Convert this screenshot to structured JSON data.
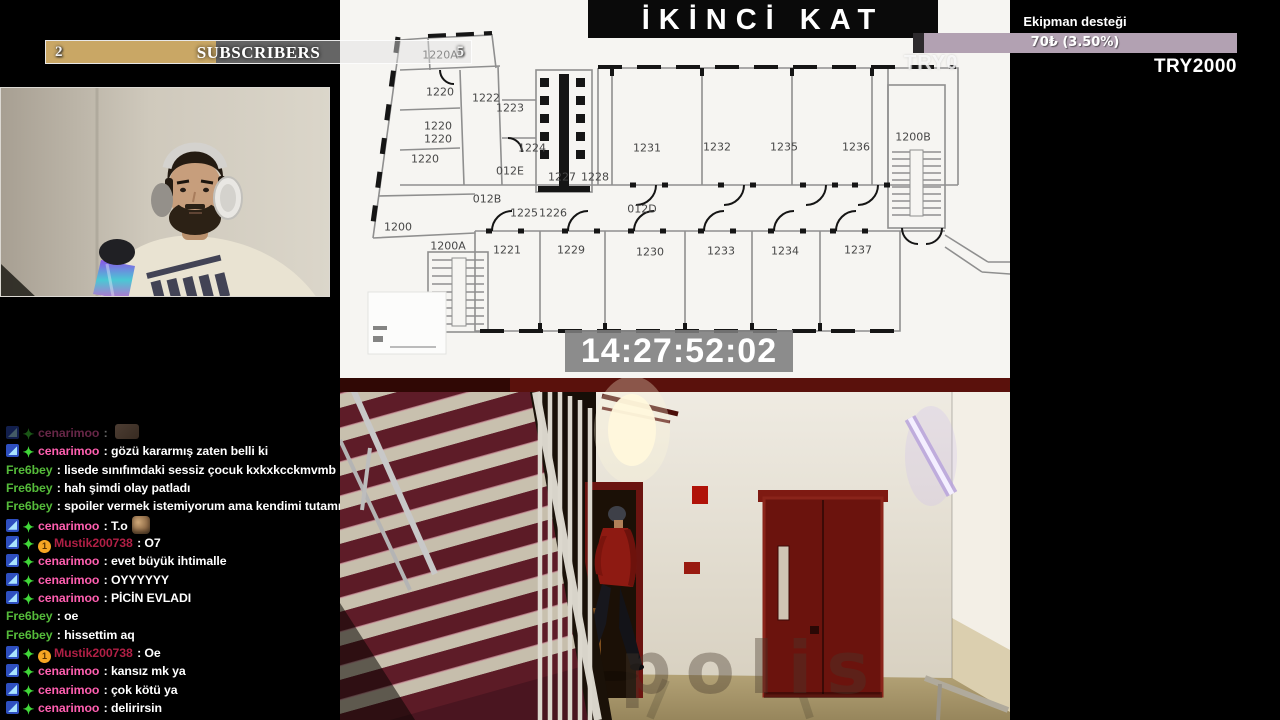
{
  "subscribers_bar": {
    "current": "2",
    "label": "SUBSCRIBERS",
    "goal": "5",
    "fill_pct": 40
  },
  "support_bar": {
    "title": "Ekipman desteği",
    "value": "70₺ (3.50%)",
    "total": "TRY2000",
    "fill_pct": 3.5
  },
  "floorplan": {
    "title": "İKİNCİ KAT",
    "timestamp": "14:27:52:02",
    "watermark": "TRY0",
    "rooms": [
      {
        "label": "1220A",
        "x": 100,
        "y": 55
      },
      {
        "label": "1220",
        "x": 100,
        "y": 92
      },
      {
        "label": "1222",
        "x": 146,
        "y": 98
      },
      {
        "label": "1223",
        "x": 170,
        "y": 108
      },
      {
        "label": "1220",
        "x": 98,
        "y": 126
      },
      {
        "label": "1220",
        "x": 98,
        "y": 139
      },
      {
        "label": "1224",
        "x": 192,
        "y": 148
      },
      {
        "label": "1220",
        "x": 85,
        "y": 159
      },
      {
        "label": "012E",
        "x": 170,
        "y": 171
      },
      {
        "label": "1227",
        "x": 222,
        "y": 177
      },
      {
        "label": "1228",
        "x": 255,
        "y": 177
      },
      {
        "label": "012B",
        "x": 147,
        "y": 199
      },
      {
        "label": "1225",
        "x": 184,
        "y": 213
      },
      {
        "label": "1226",
        "x": 213,
        "y": 213
      },
      {
        "label": "012D",
        "x": 302,
        "y": 209
      },
      {
        "label": "1200",
        "x": 58,
        "y": 227
      },
      {
        "label": "1200A",
        "x": 108,
        "y": 246
      },
      {
        "label": "1221",
        "x": 167,
        "y": 250
      },
      {
        "label": "1229",
        "x": 231,
        "y": 250
      },
      {
        "label": "1230",
        "x": 310,
        "y": 252
      },
      {
        "label": "1233",
        "x": 381,
        "y": 251
      },
      {
        "label": "1234",
        "x": 445,
        "y": 251
      },
      {
        "label": "1237",
        "x": 518,
        "y": 250
      },
      {
        "label": "1231",
        "x": 307,
        "y": 148
      },
      {
        "label": "1232",
        "x": 377,
        "y": 147
      },
      {
        "label": "1235",
        "x": 444,
        "y": 147
      },
      {
        "label": "1236",
        "x": 516,
        "y": 147
      },
      {
        "label": "1200B",
        "x": 573,
        "y": 137
      }
    ]
  },
  "cctv": {
    "watermark": "polis"
  },
  "chat": {
    "user_colors": {
      "cenarimoo": "#ff5fb0",
      "Fre6bey": "#55bb3a",
      "Mustik200738": "#b01f45"
    },
    "messages": [
      {
        "user": "cenarimoo",
        "badges": [
          "predict",
          "gift"
        ],
        "text": "",
        "emote": "small",
        "faded": true
      },
      {
        "user": "cenarimoo",
        "badges": [
          "predict",
          "gift"
        ],
        "text": "gözü kararmış zaten belli ki"
      },
      {
        "user": "Fre6bey",
        "badges": [],
        "text": "lisede sınıfımdaki sessiz çocuk kxkxkcckmvmb"
      },
      {
        "user": "Fre6bey",
        "badges": [],
        "text": "hah şimdi olay patladı"
      },
      {
        "user": "Fre6bey",
        "badges": [],
        "text": "spoiler vermek istemiyorum ama kendimi tutamıyorum"
      },
      {
        "user": "cenarimoo",
        "badges": [
          "predict",
          "gift"
        ],
        "text": "T.o",
        "emote": "face"
      },
      {
        "user": "Mustik200738",
        "badges": [
          "predict",
          "gift",
          "one"
        ],
        "text": "O7"
      },
      {
        "user": "cenarimoo",
        "badges": [
          "predict",
          "gift"
        ],
        "text": "evet büyük ihtimalle"
      },
      {
        "user": "cenarimoo",
        "badges": [
          "predict",
          "gift"
        ],
        "text": "OYYYYYY"
      },
      {
        "user": "cenarimoo",
        "badges": [
          "predict",
          "gift"
        ],
        "text": "PİCİN EVLADI"
      },
      {
        "user": "Fre6bey",
        "badges": [],
        "text": "oe"
      },
      {
        "user": "Fre6bey",
        "badges": [],
        "text": "hissettim aq"
      },
      {
        "user": "Mustik200738",
        "badges": [
          "predict",
          "gift",
          "one"
        ],
        "text": "Oe"
      },
      {
        "user": "cenarimoo",
        "badges": [
          "predict",
          "gift"
        ],
        "text": "kansız mk ya"
      },
      {
        "user": "cenarimoo",
        "badges": [
          "predict",
          "gift"
        ],
        "text": "çok kötü ya"
      },
      {
        "user": "cenarimoo",
        "badges": [
          "predict",
          "gift"
        ],
        "text": "delirirsin"
      }
    ]
  }
}
